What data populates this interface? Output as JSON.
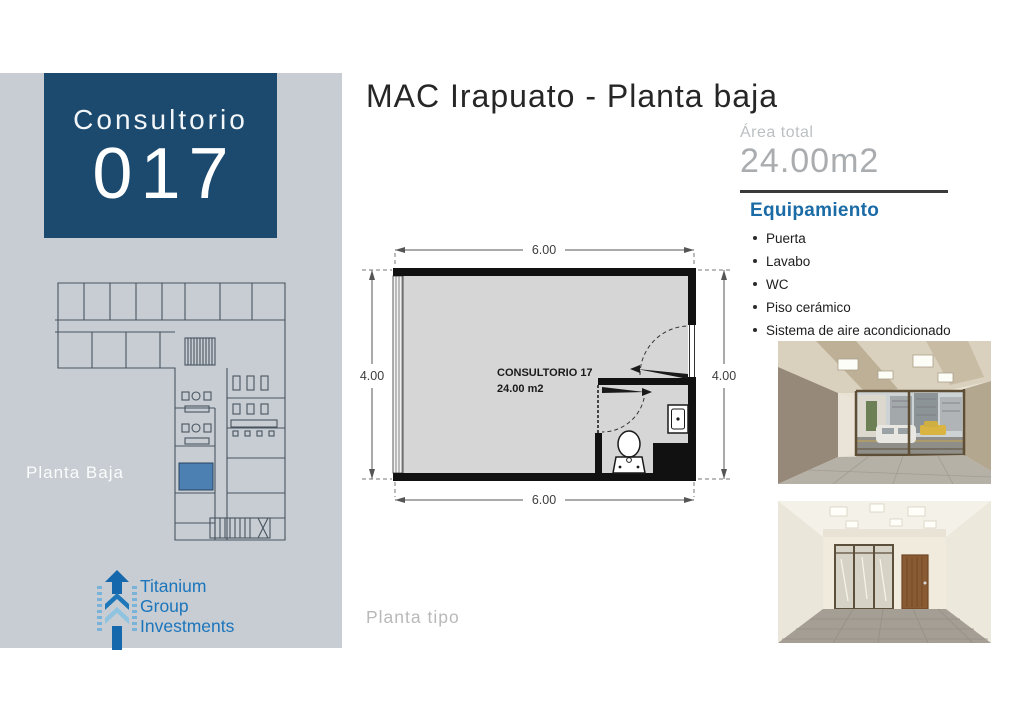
{
  "sidebar": {
    "unit_label": "Consultorio",
    "unit_number": "017",
    "floor_label": "Planta Baja",
    "logo": {
      "line1": "Titanium",
      "line2": "Group",
      "line3": "Investments"
    }
  },
  "header": {
    "title": "MAC Irapuato - Planta baja"
  },
  "area": {
    "label": "Área total",
    "value": "24.00m2"
  },
  "equipment": {
    "title": "Equipamiento",
    "items": [
      "Puerta",
      "Lavabo",
      "WC",
      "Piso cerámico",
      "Sistema de aire acondicionado"
    ]
  },
  "floor_plan": {
    "room_name": "CONSULTORIO 17",
    "room_area": "24.00 m2",
    "dim_top": "6.00",
    "dim_bottom": "6.00",
    "dim_left": "4.00",
    "dim_right": "4.00"
  },
  "footer": {
    "plan_type_label": "Planta tipo"
  },
  "colors": {
    "accent_navy": "#1b4a6e",
    "accent_blue": "#1a6ba6",
    "sidebar_bg": "#c7cdd3",
    "logo_blue": "#1b75bc",
    "muted_gray": "#a9adb0",
    "highlight_room": "#4d80b2",
    "plan_floor": "#d6d6d6",
    "wall_black": "#111111"
  }
}
